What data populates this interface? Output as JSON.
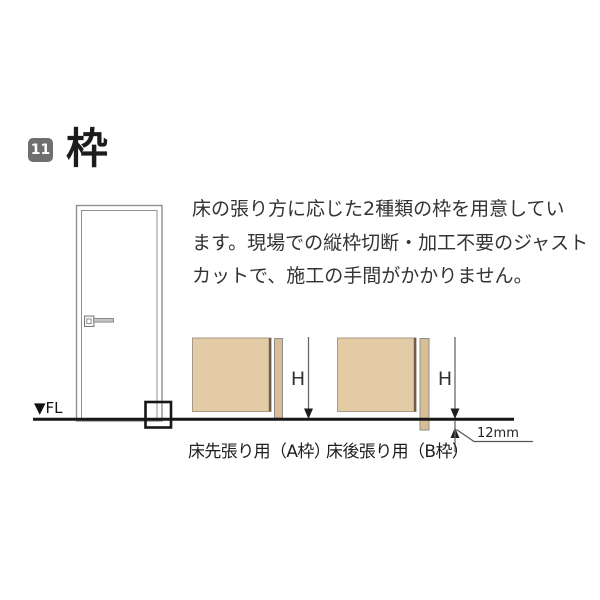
{
  "header": {
    "badge": "11",
    "title": "枠"
  },
  "intro": {
    "lines": [
      "床の張り方に応じた2種類の枠を用意してい",
      "ます。現場での縦枠切断・加工不要のジャスト",
      "カットで、施工の手間がかかりません。"
    ]
  },
  "door_figure": {
    "floor_label": "▼FL"
  },
  "diagram_a": {
    "height_label": "H",
    "caption": "床先張り用（A枠）"
  },
  "diagram_b": {
    "height_label": "H",
    "caption": "床後張り用（B枠）",
    "offset_label": "12mm"
  },
  "colors": {
    "badge_bg": "#6f6f6f",
    "wall_fill": "#e2cba5",
    "frame_fill": "#d9bd94",
    "wall_edge": "#6d5d4a",
    "floor_line": "#171717",
    "dim_line": "#6a6a6a",
    "text": "#222222"
  }
}
